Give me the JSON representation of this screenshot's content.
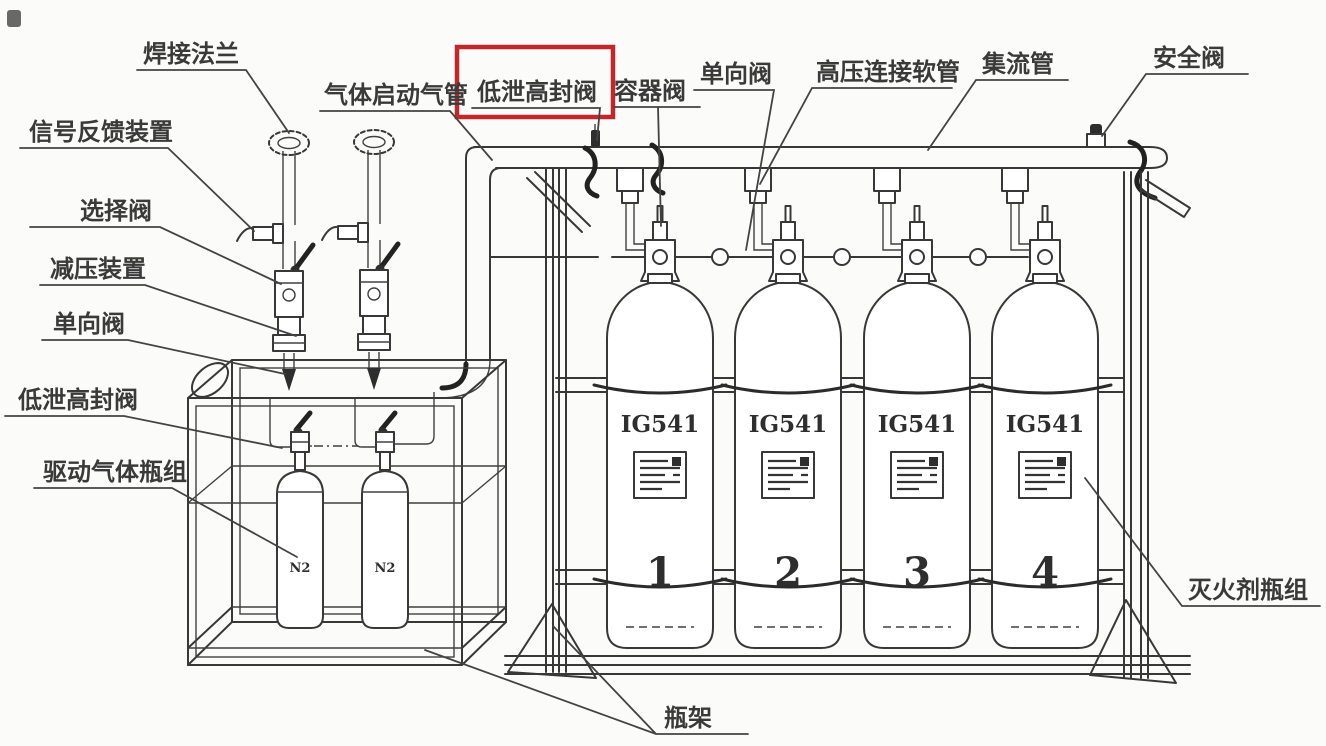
{
  "figure": {
    "title_meaning": "IG541 gas fire-extinguishing system cylinder assembly diagram",
    "background": "#fbfbf9",
    "line_color": "#383838",
    "highlight_color": "#c2272d"
  },
  "labels": {
    "weld_flange": {
      "text": "焊接法兰"
    },
    "signal_feedback": {
      "text": "信号反馈装置"
    },
    "selector_valve": {
      "text": "选择阀"
    },
    "pressure_reducer": {
      "text": "减压装置"
    },
    "check_valve_left": {
      "text": "单向阀"
    },
    "low_leak_valve_left": {
      "text": "低泄高封阀"
    },
    "driving_gas_group": {
      "text": "驱动气体瓶组"
    },
    "gas_start_pipe": {
      "text": "气体启动气管"
    },
    "low_leak_valve_top": {
      "text": "低泄高封阀",
      "highlighted": true
    },
    "container_valve": {
      "text": "容器阀"
    },
    "check_valve_top": {
      "text": "单向阀"
    },
    "hp_hose": {
      "text": "高压连接软管"
    },
    "manifold": {
      "text": "集流管"
    },
    "safety_valve": {
      "text": "安全阀"
    },
    "agent_cylinder_group": {
      "text": "灭火剂瓶组"
    },
    "cylinder_rack": {
      "text": "瓶架"
    }
  },
  "cylinders": [
    {
      "agent": "IG541",
      "number": "1"
    },
    {
      "agent": "IG541",
      "number": "2"
    },
    {
      "agent": "IG541",
      "number": "3"
    },
    {
      "agent": "IG541",
      "number": "4"
    }
  ],
  "driving_cylinders": [
    {
      "label": "N2"
    },
    {
      "label": "N2"
    }
  ]
}
